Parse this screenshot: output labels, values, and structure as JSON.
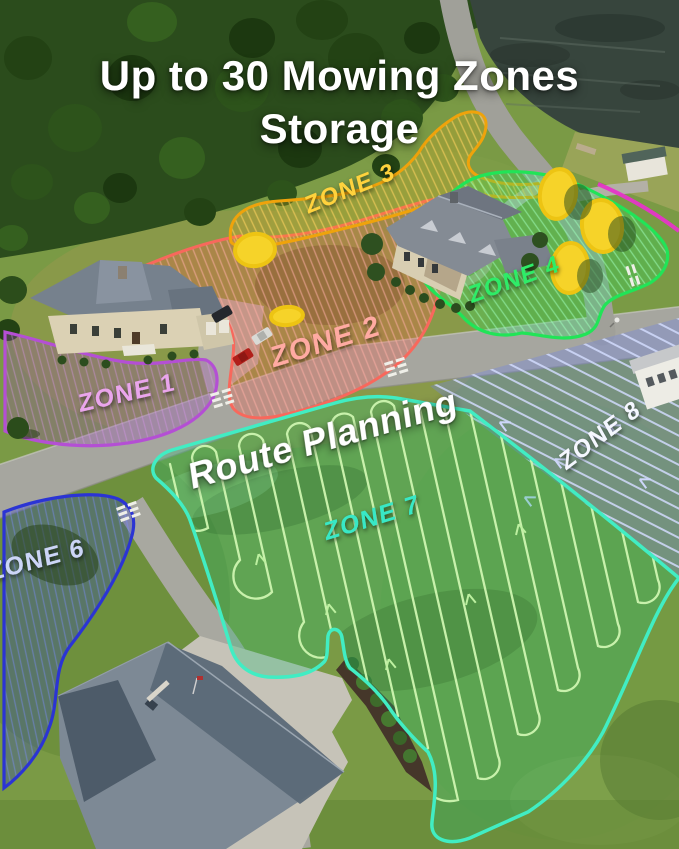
{
  "title": {
    "line1": "Up to 30 Mowing Zones",
    "line2": "Storage"
  },
  "annotations": {
    "route_planning": "Route Planning"
  },
  "zones": {
    "z1": {
      "label": "ZONE 1",
      "outline_color": "#b44fd4",
      "label_color": "#eaa5ec"
    },
    "z2": {
      "label": "ZONE 2",
      "outline_color": "#f8685c",
      "label_color": "#ffaaa2"
    },
    "z3": {
      "label": "ZONE 3",
      "outline_color": "#efa30b",
      "label_color": "#ffd23c"
    },
    "z4": {
      "label": "ZONE 4",
      "outline_color": "#21e457",
      "label_color": "#2eec67"
    },
    "z6": {
      "label": "ZONE 6",
      "outline_color": "#2b34d4",
      "label_color": "#ccd5f7"
    },
    "z7": {
      "label": "ZONE 7",
      "outline_color": "#41edc3",
      "label_color": "#37e8c6"
    },
    "z8": {
      "label": "ZONE 8",
      "outline_color": "#b9c2f0",
      "label_color": "#f5f7ff"
    }
  },
  "markers": {
    "obstacle_tree_color": "#f6d329",
    "unlabeled_zone_boundary_color": "#e635c8"
  }
}
